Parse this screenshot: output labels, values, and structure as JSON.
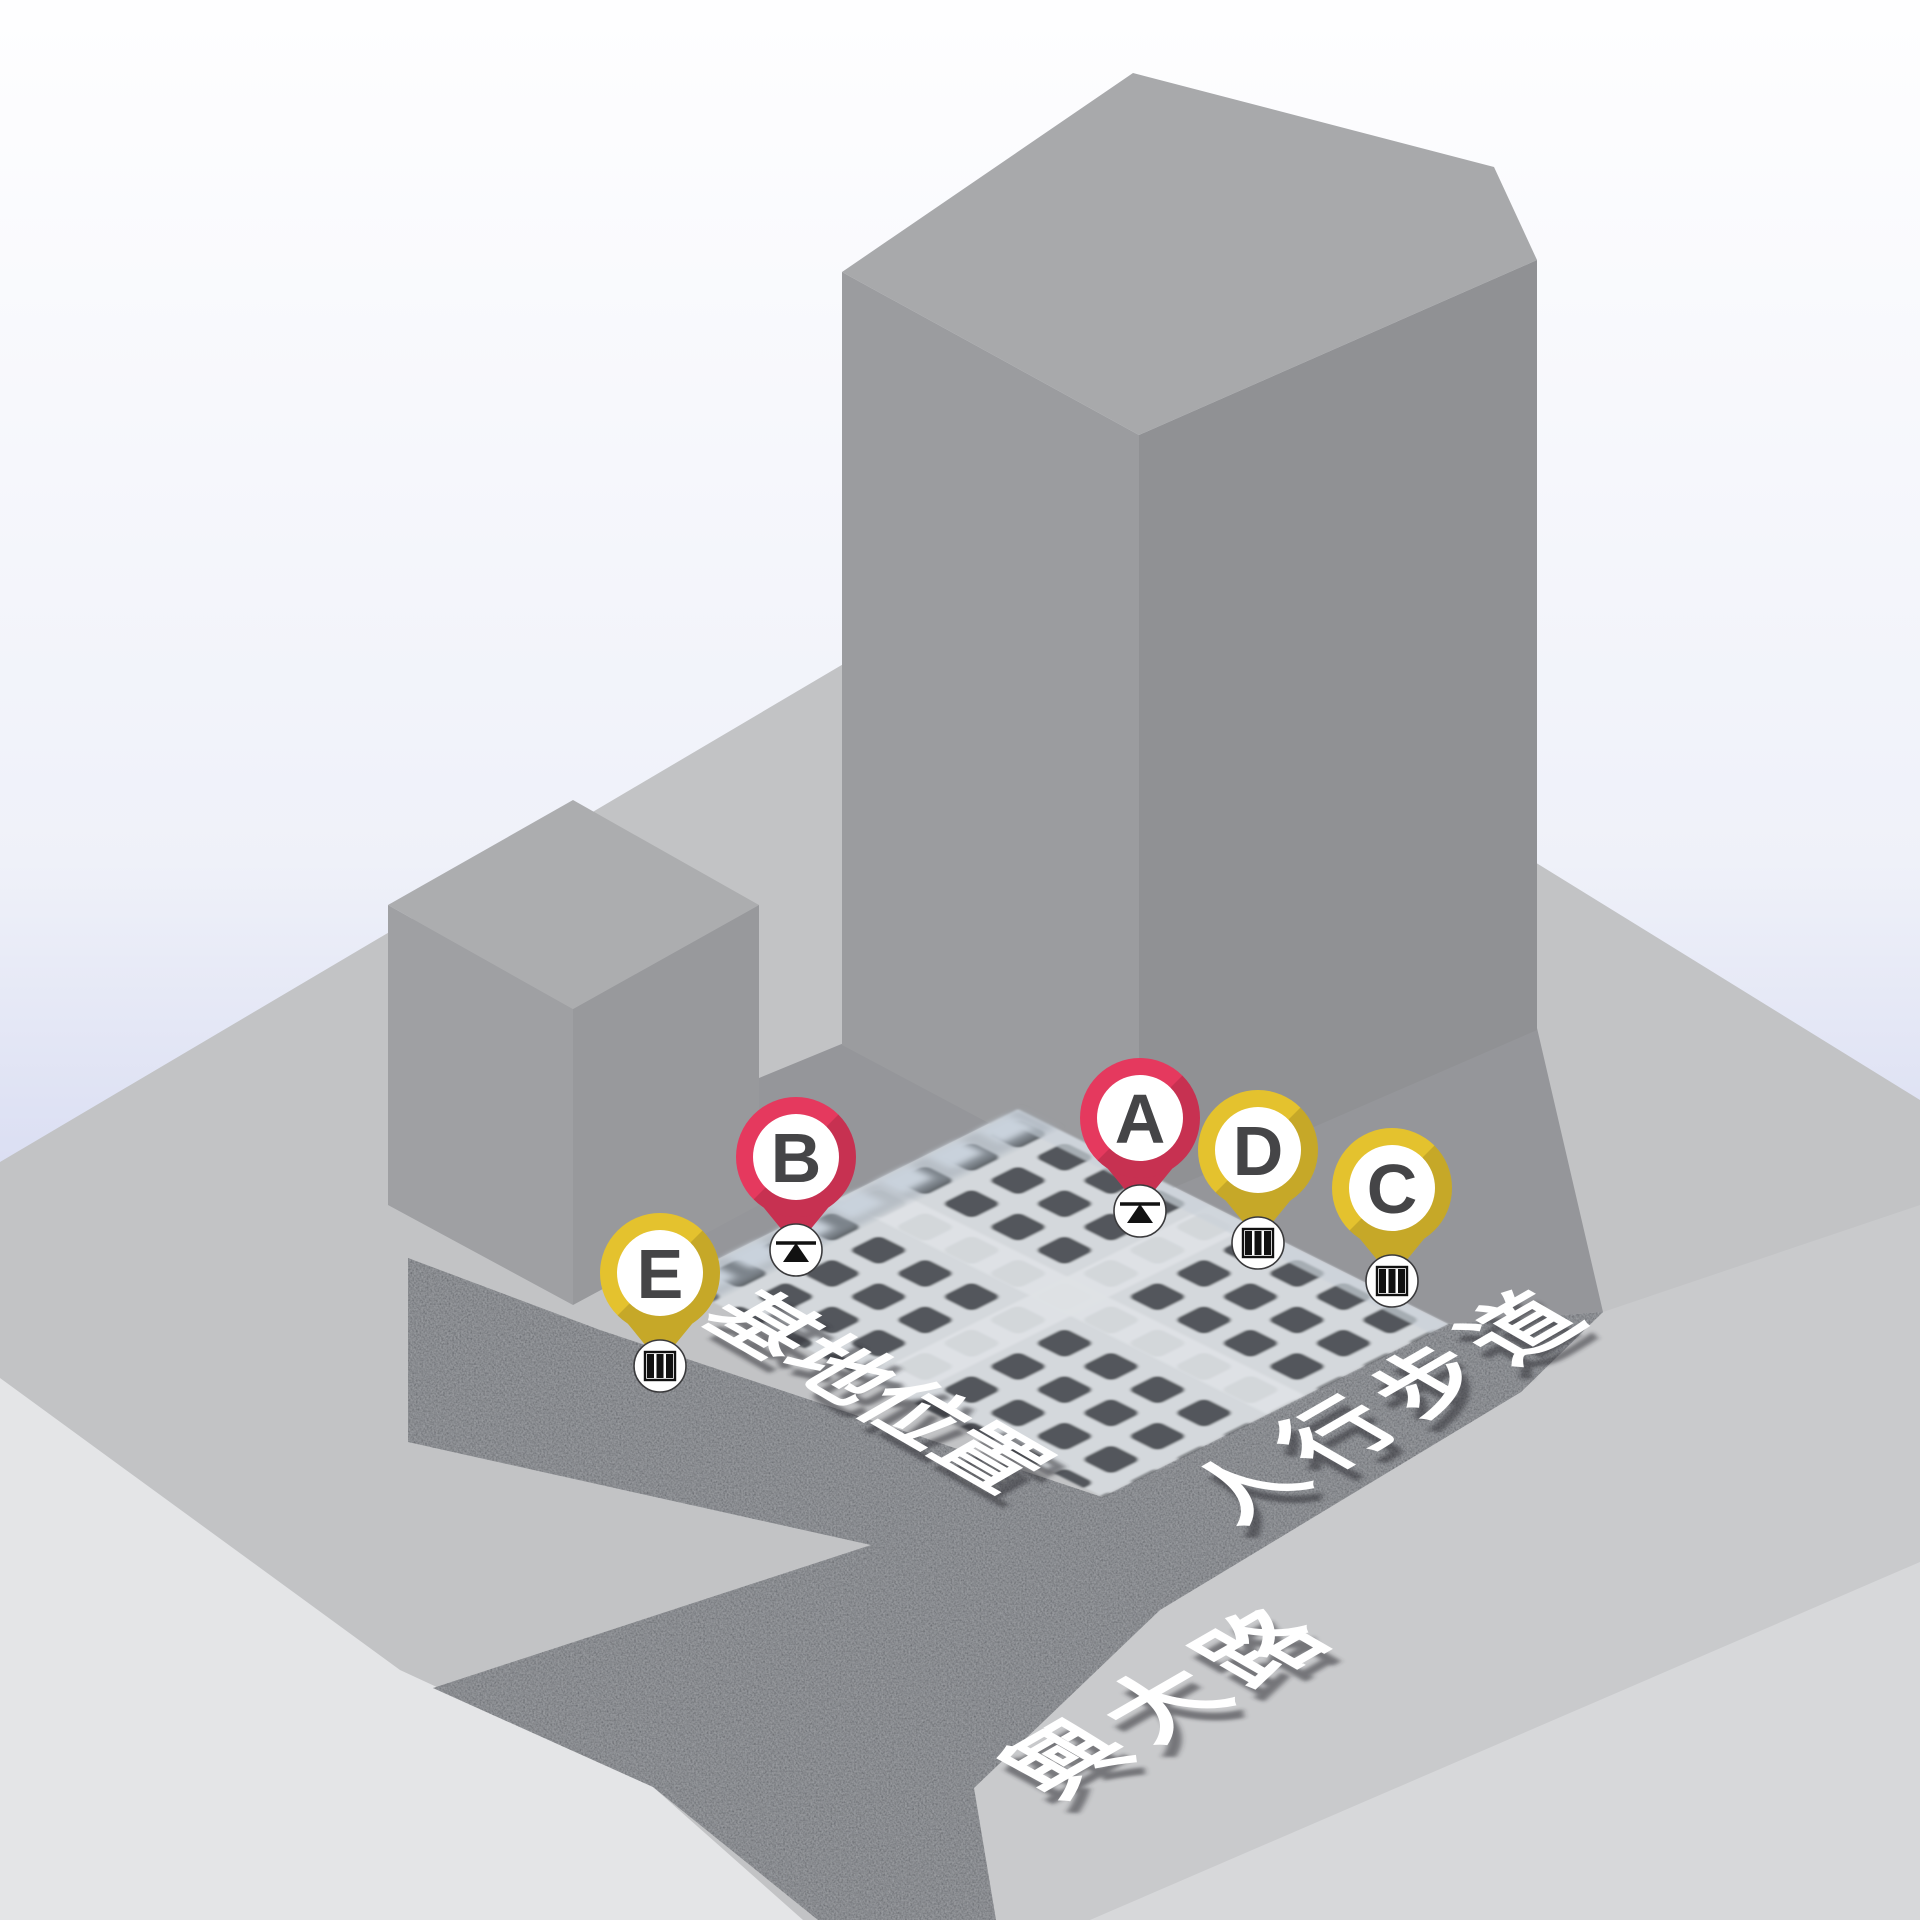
{
  "scene": {
    "type": "isometric-site-map",
    "background": {
      "sky_top": "#FEFEFF",
      "sky_mid": "#EFF1F9",
      "sky_bottom": "#D9DDF2"
    },
    "ground": {
      "platform_color": "#C2C3C5",
      "road_surface_color": "#C9CACC",
      "sidewalk_base_color": "#A2A4A8",
      "sidewalk_speckle_color": "#54575D",
      "far_sidewalk_color": "#D7D8DA",
      "light_corner_color": "#E4E5E7",
      "shadow_strip_color": "#95969A"
    },
    "buildings": {
      "tall": {
        "top": "#A8A9AB",
        "left": "#9B9C9F",
        "right": "#909194"
      },
      "small": {
        "top": "#ACADAF",
        "left": "#9FA0A3",
        "right": "#98999C"
      }
    },
    "site_pit": {
      "beam_color": "#D4D8DC",
      "cell_color": "#53575B",
      "cross_beam_color": "#DEE2E5",
      "wall_panel_color": "#C9D2DC",
      "wall_haze_color": "#9FA8B2"
    }
  },
  "markers": [
    {
      "id": "A",
      "color": "#E5395E",
      "letter_color": "#454547",
      "type": "benchmark",
      "transform": "translate(1140,1118)"
    },
    {
      "id": "B",
      "color": "#E5395E",
      "letter_color": "#454547",
      "type": "benchmark",
      "transform": "translate(796,1157)"
    },
    {
      "id": "C",
      "color": "#E4C22E",
      "letter_color": "#454547",
      "type": "gauge",
      "transform": "translate(1392,1188)"
    },
    {
      "id": "D",
      "color": "#E4C22E",
      "letter_color": "#454547",
      "type": "gauge",
      "transform": "translate(1258,1150)"
    },
    {
      "id": "E",
      "color": "#E4C22E",
      "letter_color": "#454547",
      "type": "gauge",
      "transform": "translate(660,1273)"
    }
  ],
  "labels": [
    {
      "text": "基地位置"
    },
    {
      "text": "人行步道"
    },
    {
      "text": "興大路"
    }
  ]
}
